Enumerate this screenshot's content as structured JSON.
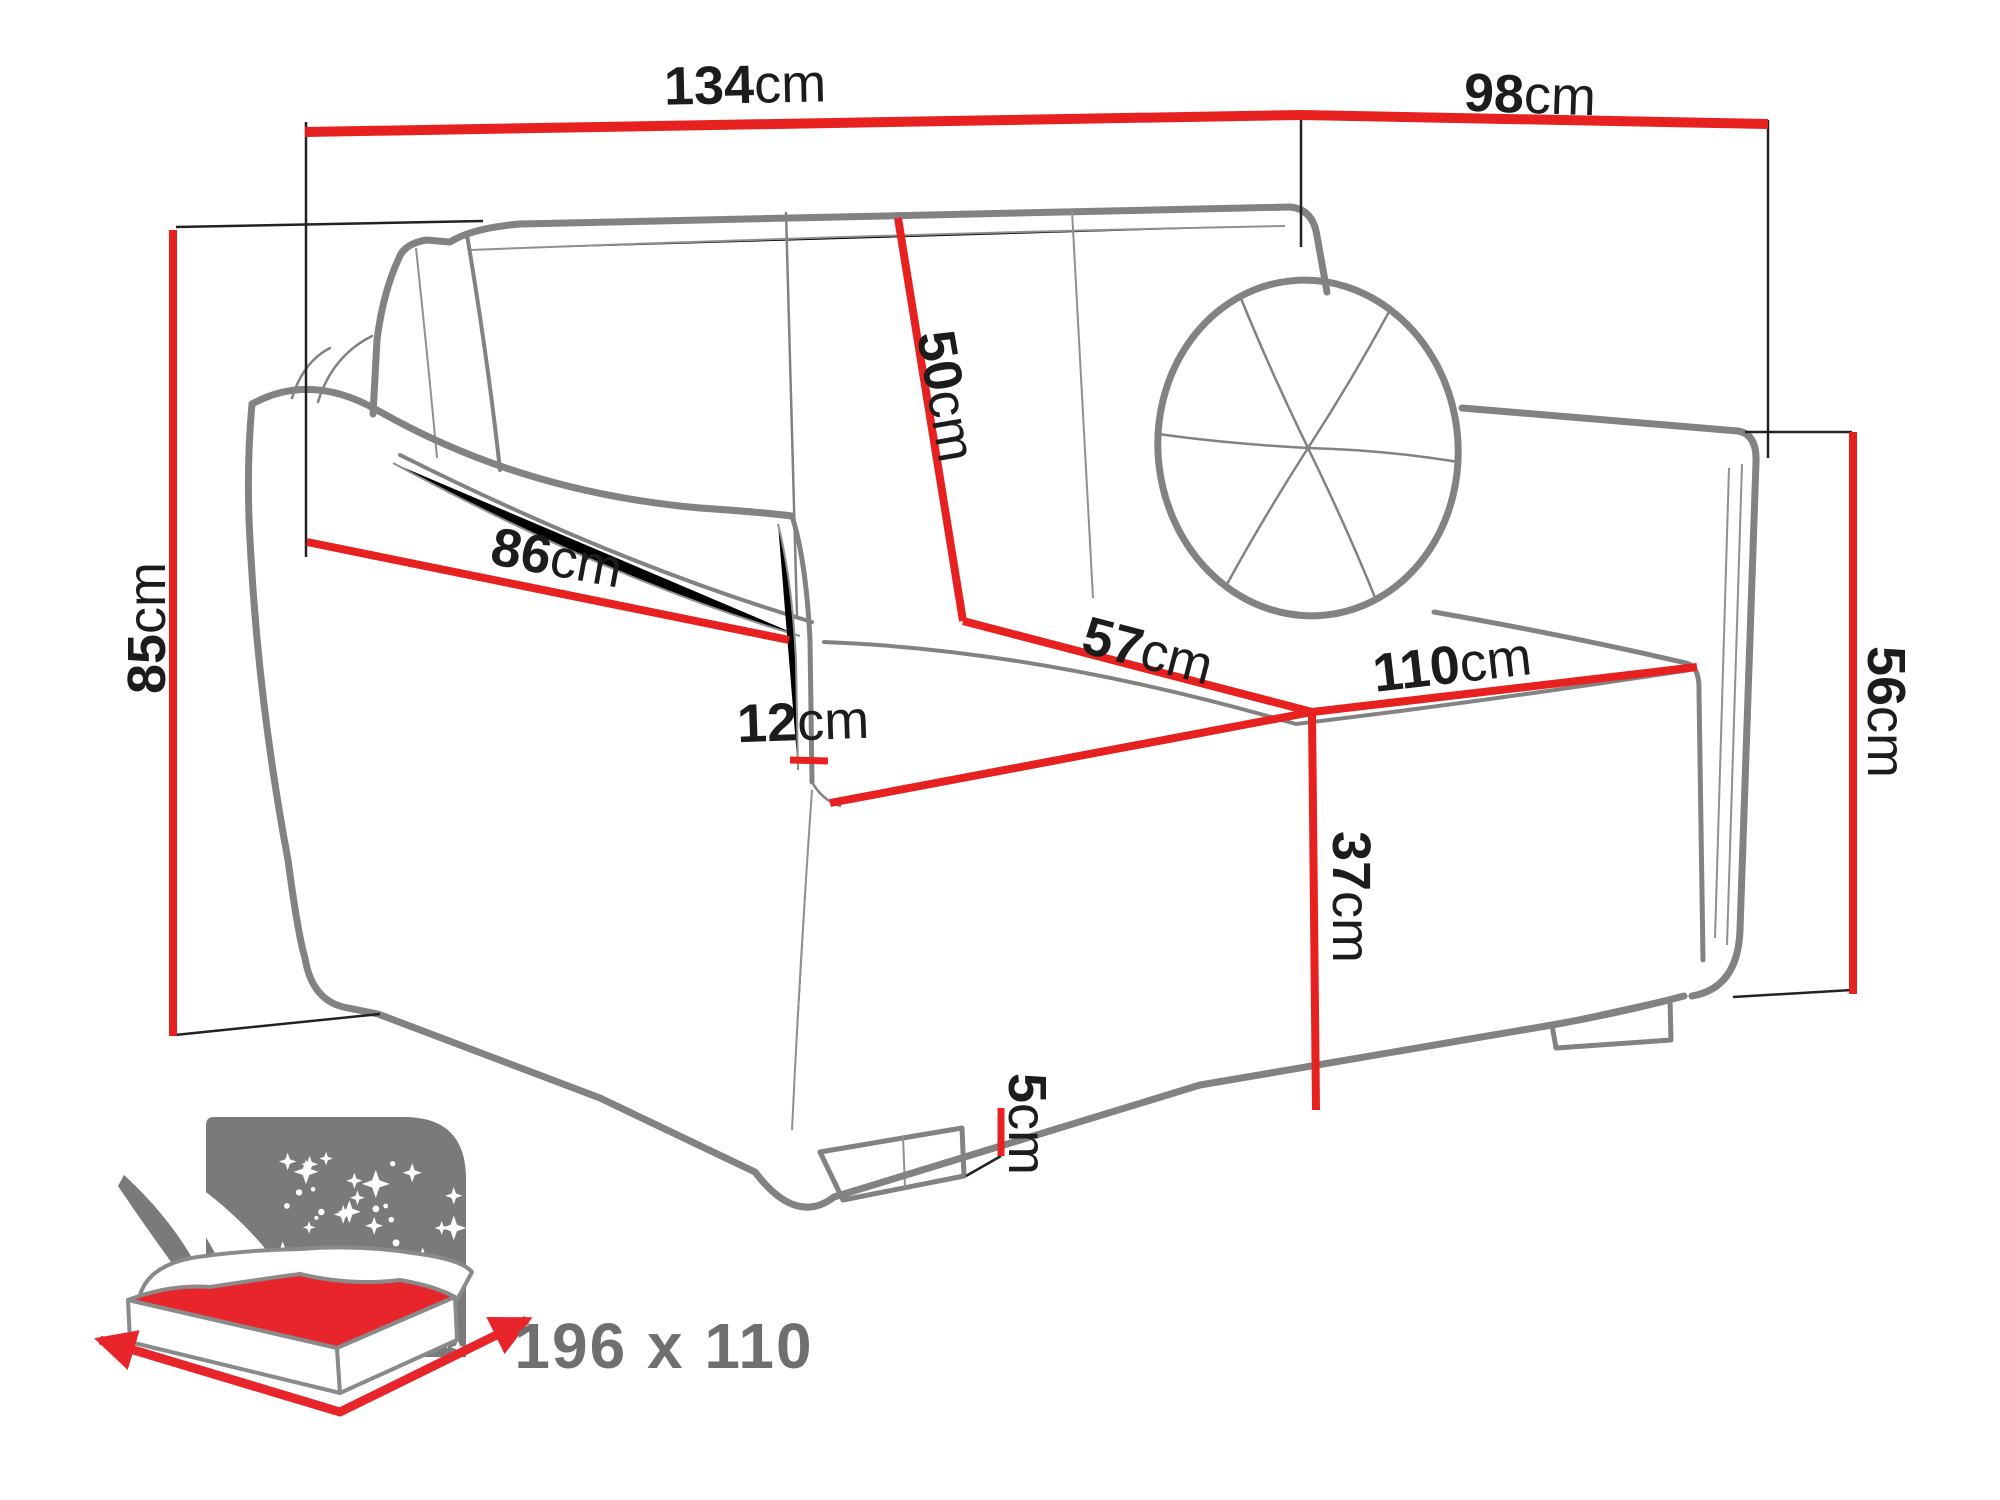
{
  "meta": {
    "type": "furniture-dimension-diagram",
    "subject": "two-seat sofa bed sketch with dimension callouts and fold-out bed icon"
  },
  "colors": {
    "dimension_line_red": "#e7211f",
    "sofa_outline_gray": "#828282",
    "label_text": "#1c1c1c",
    "icon_gray": "#7a7a7a",
    "mattress_red": "#e8252b",
    "sleeping_size_text": "#6f6f6f"
  },
  "dimensions": {
    "width_overall": {
      "value": "134",
      "unit": "cm"
    },
    "depth_overall": {
      "value": "98",
      "unit": "cm"
    },
    "height_overall": {
      "value": "85",
      "unit": "cm"
    },
    "backrest_height": {
      "value": "50",
      "unit": "cm"
    },
    "armrest_length": {
      "value": "86",
      "unit": "cm"
    },
    "armrest_thickness": {
      "value": "12",
      "unit": "cm"
    },
    "seat_depth": {
      "value": "57",
      "unit": "cm"
    },
    "seat_width": {
      "value": "110",
      "unit": "cm"
    },
    "armrest_height": {
      "value": "56",
      "unit": "cm"
    },
    "seat_height": {
      "value": "37",
      "unit": "cm"
    },
    "leg_height": {
      "value": "5",
      "unit": "cm"
    }
  },
  "sleeping_area": {
    "label": "196 x 110",
    "icon": "sleeping-function-icon",
    "star_count": 46
  }
}
